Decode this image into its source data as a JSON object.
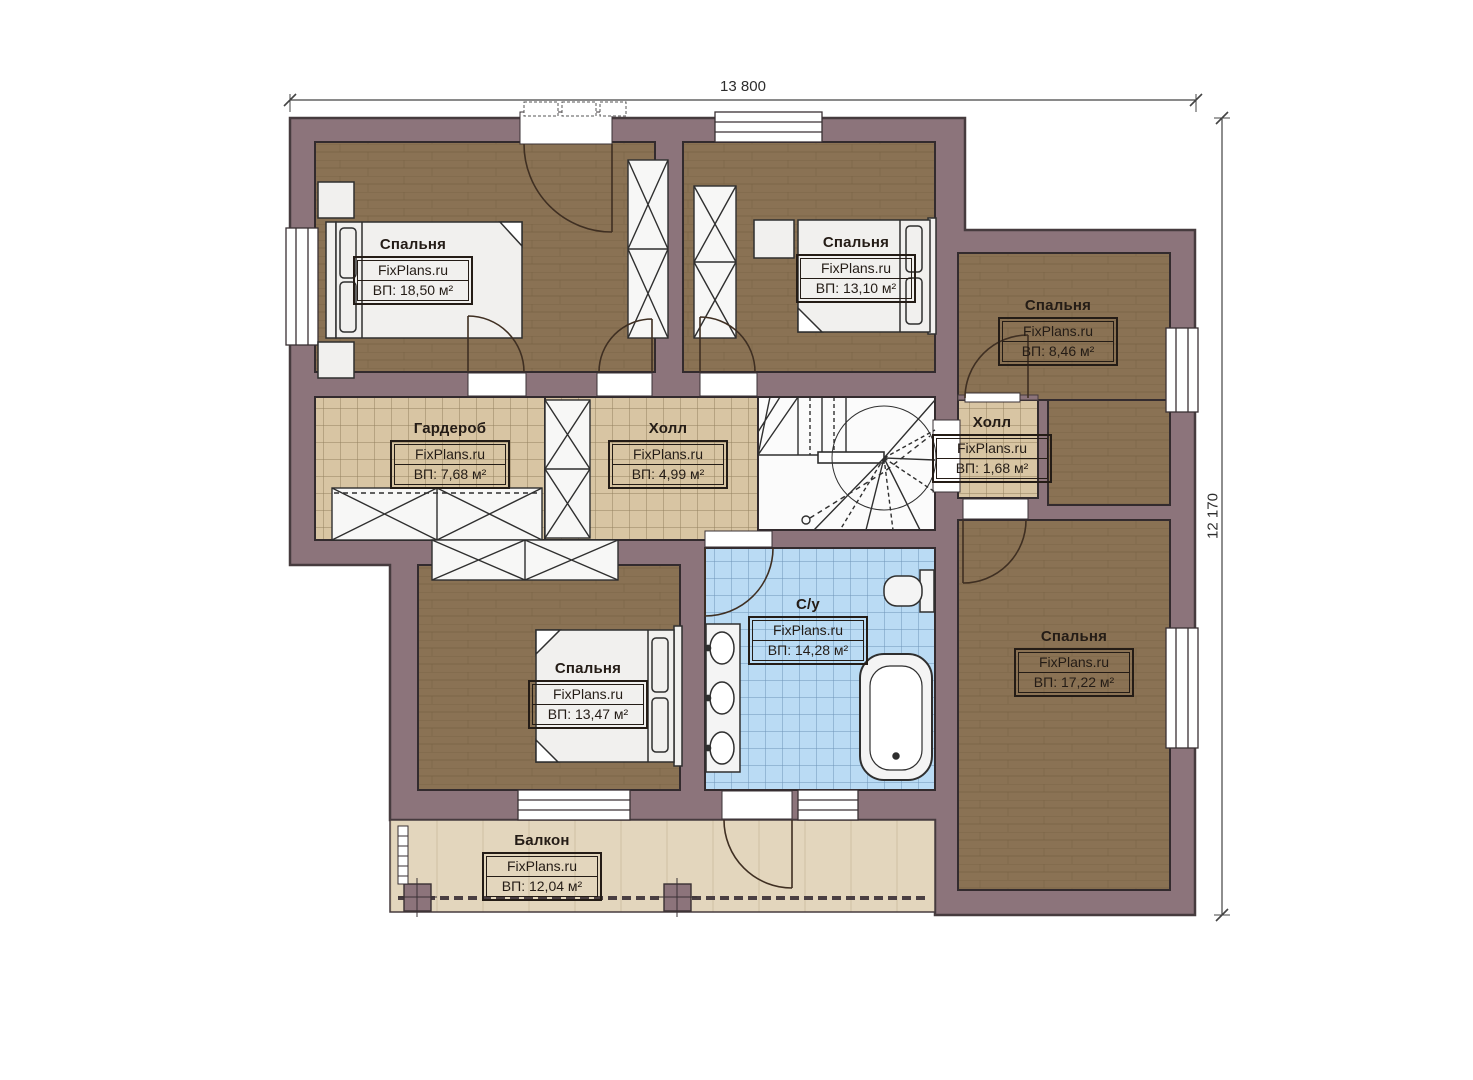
{
  "dimensions": {
    "width_label": "13 800",
    "height_label": "12 170"
  },
  "rooms": [
    {
      "id": "bedroom-top-left",
      "name": "Спальня",
      "brand": "FixPlans.ru",
      "area": "ВП: 18,50 м²"
    },
    {
      "id": "bedroom-top-middle",
      "name": "Спальня",
      "brand": "FixPlans.ru",
      "area": "ВП: 13,10 м²"
    },
    {
      "id": "bedroom-top-right",
      "name": "Спальня",
      "brand": "FixPlans.ru",
      "area": "ВП: 8,46 м²"
    },
    {
      "id": "wardrobe",
      "name": "Гардероб",
      "brand": "FixPlans.ru",
      "area": "ВП: 7,68 м²"
    },
    {
      "id": "hall-main",
      "name": "Холл",
      "brand": "FixPlans.ru",
      "area": "ВП: 4,99 м²"
    },
    {
      "id": "hall-small",
      "name": "Холл",
      "brand": "FixPlans.ru",
      "area": "ВП: 1,68 м²"
    },
    {
      "id": "bathroom",
      "name": "С/у",
      "brand": "FixPlans.ru",
      "area": "ВП: 14,28 м²"
    },
    {
      "id": "bedroom-bottom-left",
      "name": "Спальня",
      "brand": "FixPlans.ru",
      "area": "ВП: 13,47 м²"
    },
    {
      "id": "bedroom-right",
      "name": "Спальня",
      "brand": "FixPlans.ru",
      "area": "ВП: 17,22 м²"
    },
    {
      "id": "balcony",
      "name": "Балкон",
      "brand": "FixPlans.ru",
      "area": "ВП: 12,04 м²"
    }
  ],
  "colors": {
    "wall": "#8c747b",
    "wood_floor": "#8a7254",
    "tile_tan": "#d8c5a3",
    "tile_blue": "#badbf4",
    "balcony_floor": "#e3d6bd",
    "furniture": "#f1f0ee",
    "outline": "#3a3134"
  }
}
